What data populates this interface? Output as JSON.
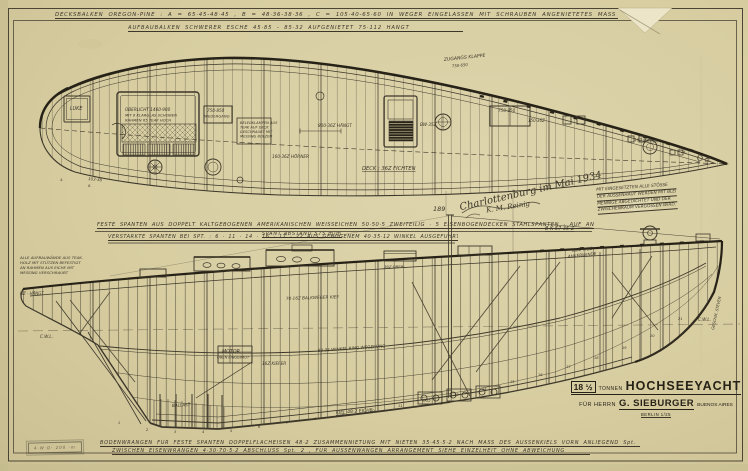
{
  "top_notes": {
    "line1": "DECKSBALKEN OREGON-PINE : A = 65·45-48·45 , B = 48·36-38·36 , C = 105·40-65·60 IN WEGER EINGELASSEN MIT SCHRAUBEN ANGENIETETES MASS SEIN.",
    "line2": "AUFBAUBALKEN SCHWERER ESCHE 45·85 - 85·32 AUFGENIETET 75·112 HÄNGT"
  },
  "mid_notes": {
    "line1": "FESTE SPANTEN AUS DOPPELT KALTGEBOGENEN AMERIKANISCHEN WEISSEICHEN 50·50·5 ZWEITEILIG · 5 EISENBOGENDECKEN STAHLSPANTEN · AUF ANLIEGEND MASS Spt. 22",
    "sub": "SPANT ABSTAND 575 m/m",
    "line2": "VERSTÄRKTE SPANTEN BEI SPT. : 6 · 11 · 14 · 16 · 17 · 22 AUS GEBOGENEM 40·35·12 WINKEL AUSGEFÜHRT"
  },
  "side_note": {
    "lines": [
      "MIT EINGESETZTEN ALLE STÖSSE",
      "DER AUSSENHAUT WERDEN MIT BLEI",
      "MENNIGE ABGEDICHTET UND DER",
      "ZWISCHENRAUM VERGOSSEN WIRD."
    ]
  },
  "signature": {
    "place_date": "Charlottenburg im Mai 1934",
    "name": "K. M. Reinig"
  },
  "title_block": {
    "tonnage": "18 ½",
    "tonnen": "TONNEN",
    "title": "HOCHSEEYACHT",
    "for_prefix": "FÜR HERRN",
    "owner": "G. SIEBURGER",
    "city": "BUENOS AIRES",
    "sub": "BERLIN 1/25"
  },
  "bottom_notes": {
    "line1": "BODENWRANGEN FÜR FESTE SPANTEN DOPPELFLACHEISEN 48·2 ZUSAMMENNIETUNG MIT NIETEN 35·45·5·2 NACH MASS DES AUSSENKIELS VORN ANLIEGEND Spt. 2",
    "line2": "ZWISCHEN EISENWRANGEN 4·30·70·5·2 ABSCHLUSS Spt. 2 , FÜR AUSSENWANGEN ARRANGEMENT SIEHE EINZELHEIT OHNE ABWEICHUNG"
  },
  "stamp": {
    "text": "4·W·D· 200 ·m"
  },
  "colors": {
    "paper": "#d8cfa4",
    "paper_light": "#e4dcb6",
    "ink": "#3d372a",
    "ink_heavy": "#272217"
  },
  "annotations": [
    {
      "t": "LUKE",
      "x": 70,
      "y": 110,
      "s": 4.8
    },
    {
      "t": "OBERLICHT 1460·900",
      "x": 125,
      "y": 111,
      "s": 4.2
    },
    {
      "t": "MIT 8 KLARGLAS SCHEIBEN",
      "x": 125,
      "y": 116.5,
      "s": 3.8
    },
    {
      "t": "RAHMEN 65 TEAK HOCH",
      "x": 125,
      "y": 121.5,
      "s": 3.8
    },
    {
      "t": "750·850",
      "x": 207,
      "y": 112,
      "s": 4.2
    },
    {
      "t": "NIEDERGANG",
      "x": 204,
      "y": 117.5,
      "s": 3.8
    },
    {
      "t": "BELEGKLAMPEN AUS",
      "x": 240,
      "y": 124,
      "s": 3.6
    },
    {
      "t": "TEAK AUF DECK",
      "x": 240,
      "y": 128.5,
      "s": 3.6
    },
    {
      "t": "GESCHRAUBT MIT",
      "x": 240,
      "y": 133,
      "s": 3.6
    },
    {
      "t": "MESSING BOLZEN",
      "x": 240,
      "y": 137.5,
      "s": 3.6
    },
    {
      "t": "ZUGANGS KLAPPE",
      "x": 444,
      "y": 61,
      "s": 4.6,
      "r": -6
    },
    {
      "t": "750·650",
      "x": 452,
      "y": 67.5,
      "s": 3.9,
      "r": -6
    },
    {
      "t": "750·850",
      "x": 498,
      "y": 112,
      "s": 4.2
    },
    {
      "t": "800·36Z HÄNGT",
      "x": 318,
      "y": 127,
      "s": 4.2
    },
    {
      "t": "BW·35Z",
      "x": 420,
      "y": 126,
      "s": 4.2
    },
    {
      "t": "150·36Z",
      "x": 528,
      "y": 122,
      "s": 4
    },
    {
      "t": "16Z WEGER",
      "x": 634,
      "y": 141,
      "s": 4,
      "r": 4
    },
    {
      "t": "DECK : 36Z FICHTEN",
      "x": 362,
      "y": 170,
      "s": 5.2,
      "u": 1
    },
    {
      "t": "160·36Z HÖRNER",
      "x": 272,
      "y": 158,
      "s": 4.2
    },
    {
      "t": "103·38",
      "x": 88,
      "y": 180,
      "s": 4,
      "r": 6
    },
    {
      "t": "24.",
      "x": 681,
      "y": 153,
      "s": 3.6
    },
    {
      "t": "25.",
      "x": 706,
      "y": 159,
      "s": 3.6
    },
    {
      "t": "4.",
      "x": 60,
      "y": 181,
      "s": 3.6
    },
    {
      "t": "8.",
      "x": 88,
      "y": 187,
      "s": 3.6
    },
    {
      "t": "ALLE AUFBAUWÄNDE AUS TEAK-",
      "x": 20,
      "y": 259,
      "s": 3.9
    },
    {
      "t": "HOLZ MIT STÜTZEN BEFESTIGT",
      "x": 20,
      "y": 264,
      "s": 3.9
    },
    {
      "t": "AN RAHMEN AUS EICHE MIT",
      "x": 20,
      "y": 269,
      "s": 3.9
    },
    {
      "t": "MESSING VERSCHRAUBT",
      "x": 20,
      "y": 274,
      "s": 3.9
    },
    {
      "t": "HZ · HÄNGT",
      "x": 20,
      "y": 295,
      "s": 4
    },
    {
      "t": "C.W.L.",
      "x": 40,
      "y": 338,
      "s": 4.2
    },
    {
      "t": "B·K 57·35·Z",
      "x": 545,
      "y": 230,
      "s": 5,
      "u": 1
    },
    {
      "t": "KRÄFTIGE",
      "x": 572,
      "y": 252,
      "s": 4.2,
      "r": -6
    },
    {
      "t": "ANKERWINDE",
      "x": 568,
      "y": 258,
      "s": 4.2,
      "r": -6
    },
    {
      "t": "189",
      "x": 433,
      "y": 211,
      "s": 6.5
    },
    {
      "t": "70·16Z BALKWEGER KIEF.",
      "x": 286,
      "y": 300,
      "s": 4.2,
      "r": -2
    },
    {
      "t": "50·35 WINKEL RING WEGERUNG",
      "x": 318,
      "y": 352,
      "s": 4.2,
      "r": -4
    },
    {
      "t": "36Z OBERL.",
      "x": 384,
      "y": 268,
      "s": 3.8
    },
    {
      "t": "MOTOR",
      "x": 222,
      "y": 353,
      "s": 4.8
    },
    {
      "t": "OBEN EINGEBAUT",
      "x": 217,
      "y": 358.5,
      "s": 3.6
    },
    {
      "t": "16Z KIEFER",
      "x": 262,
      "y": 365,
      "s": 4.2
    },
    {
      "t": "KIEL 48·2 EICHE",
      "x": 336,
      "y": 414,
      "s": 4.6,
      "r": -4,
      "u": 1
    },
    {
      "t": "C.W.L.",
      "x": 698,
      "y": 321,
      "s": 4.2
    },
    {
      "t": "GESCHM. STEVEN",
      "x": 714,
      "y": 330,
      "s": 3.8,
      "r": -78
    },
    {
      "t": "BALLAST",
      "x": 172,
      "y": 407,
      "s": 4.2,
      "r": -3
    }
  ],
  "frame_numbers": [
    {
      "n": "1",
      "x": 118,
      "y": 424
    },
    {
      "n": "2",
      "x": 146,
      "y": 431
    },
    {
      "n": "3",
      "x": 174,
      "y": 433
    },
    {
      "n": "4",
      "x": 202,
      "y": 433
    },
    {
      "n": "5",
      "x": 230,
      "y": 432
    },
    {
      "n": "6",
      "x": 258,
      "y": 428
    },
    {
      "n": "7",
      "x": 286,
      "y": 424
    },
    {
      "n": "8",
      "x": 314,
      "y": 420
    },
    {
      "n": "9",
      "x": 342,
      "y": 416
    },
    {
      "n": "10",
      "x": 370,
      "y": 412
    },
    {
      "n": "11",
      "x": 398,
      "y": 407
    },
    {
      "n": "12",
      "x": 426,
      "y": 402
    },
    {
      "n": "13",
      "x": 454,
      "y": 396
    },
    {
      "n": "14",
      "x": 482,
      "y": 390
    },
    {
      "n": "15",
      "x": 510,
      "y": 383
    },
    {
      "n": "16",
      "x": 538,
      "y": 376
    },
    {
      "n": "17",
      "x": 566,
      "y": 368
    },
    {
      "n": "18",
      "x": 594,
      "y": 359
    },
    {
      "n": "19",
      "x": 622,
      "y": 349
    },
    {
      "n": "20",
      "x": 650,
      "y": 337
    },
    {
      "n": "21",
      "x": 678,
      "y": 320
    }
  ]
}
